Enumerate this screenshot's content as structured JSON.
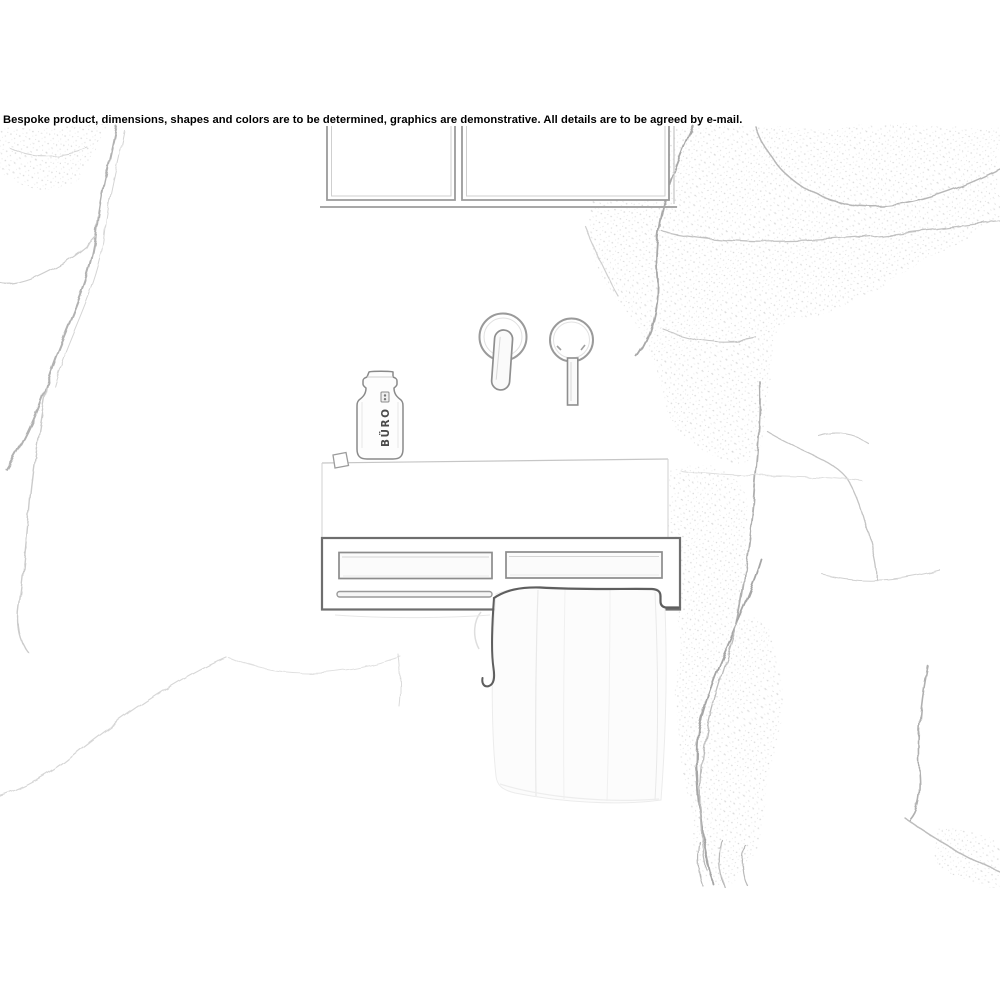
{
  "disclaimer": "Bespoke product, dimensions, shapes and colors are to be determined, graphics are demonstrative. All details are to be agreed by e-mail.",
  "bottle": {
    "label": "BÜRO"
  },
  "colors": {
    "background": "#ffffff",
    "disclaimer_text": "#000000",
    "sketch_dark": "#5e5e5e",
    "sketch_mid": "#9a9a9a",
    "sketch_faint": "#cccccc",
    "marble_vein": "#b2b2b2"
  },
  "scene_objects": [
    "marble-wall",
    "mirror-cabinet",
    "faucet-handle",
    "faucet-spout",
    "glass-bottle",
    "soap-bar",
    "washbasin",
    "shelf-unit",
    "shelf-niche-left",
    "shelf-niche-right",
    "towel-rail",
    "towel"
  ]
}
